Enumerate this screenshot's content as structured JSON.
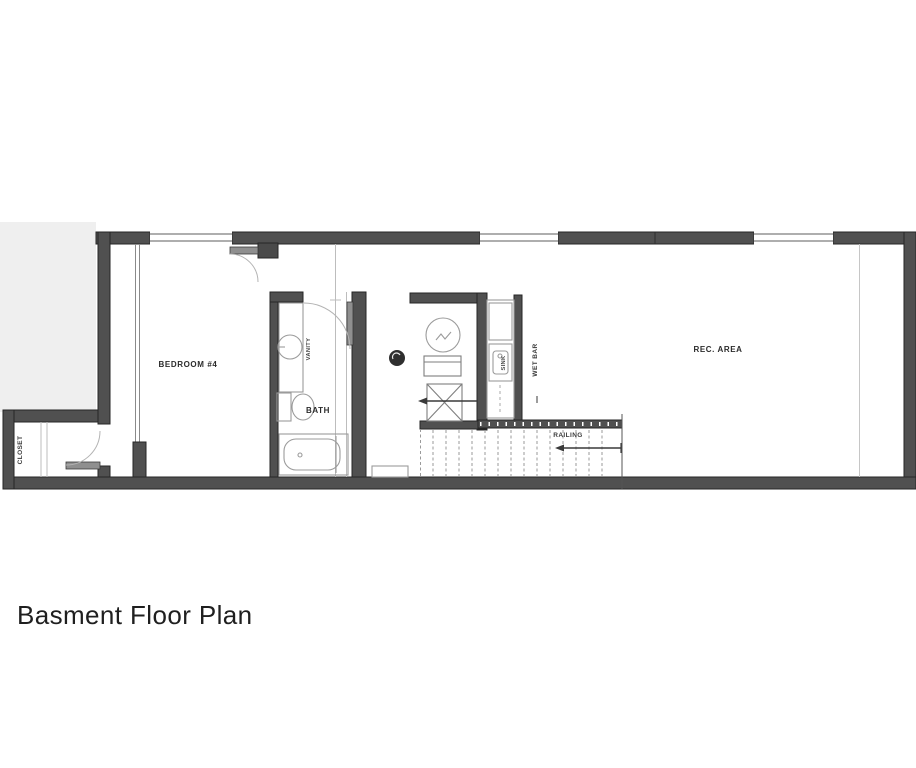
{
  "title": "Basment Floor Plan",
  "floorplan": {
    "labels": {
      "bedroom": "BEDROOM #4",
      "closet": "CLOSET",
      "bath": "BATH",
      "vanity": "VANITY",
      "sink": "SINK",
      "wet_bar": "WET BAR",
      "railing": "RAILING",
      "rec_area": "REC. AREA"
    },
    "colors": {
      "wall": "#505050",
      "fixture_line": "#9b9b9b",
      "text": "#2b2b2b",
      "background": "#ffffff"
    }
  }
}
